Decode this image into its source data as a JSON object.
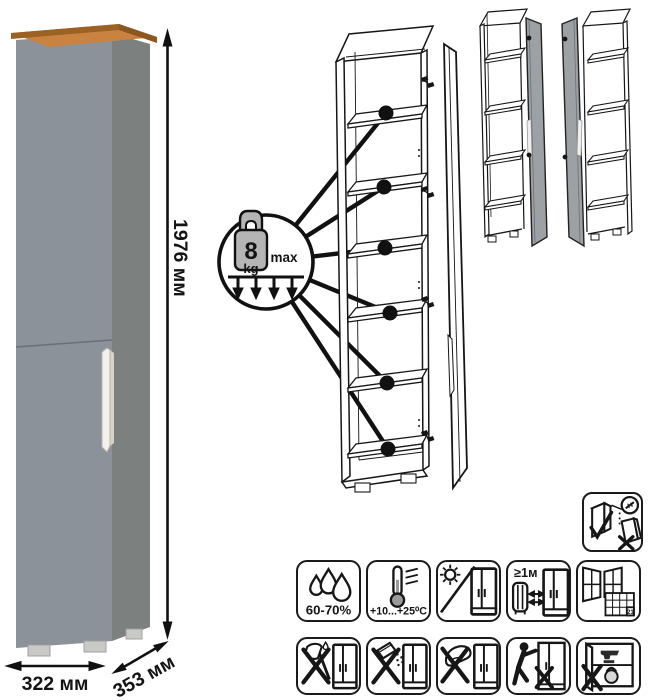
{
  "product": {
    "dimensions": {
      "height": "1976 мм",
      "width": "322 мм",
      "depth": "353 мм"
    },
    "colors": {
      "front": "#8b9299",
      "side": "#7c807e",
      "top_trim": "#c9823f",
      "top_trim_edge": "#9c6124",
      "top_trim_side": "#8d5520",
      "handle": "#f2f1ee",
      "feet": "#c9c9c7",
      "door_shade": "#9ba1a5",
      "outline": "#161616"
    }
  },
  "load_callout": {
    "value": "8",
    "unit": "kg",
    "max_label": "max"
  },
  "icons": {
    "wall_anchor": {
      "name": "wall-anchor-icon"
    },
    "grid": [
      {
        "name": "humidity-icon",
        "label": "60-70%"
      },
      {
        "name": "temperature-icon",
        "label": "+10...+25⁰C"
      },
      {
        "name": "no-direct-sunlight-icon",
        "label": ""
      },
      {
        "name": "heat-distance-icon",
        "label": "≥1м"
      },
      {
        "name": "ventilation-icon",
        "label": "21"
      },
      {
        "name": "no-sharp-tools-icon",
        "label": ""
      },
      {
        "name": "no-abrasive-powder-icon",
        "label": ""
      },
      {
        "name": "no-wet-sponge-icon",
        "label": ""
      },
      {
        "name": "no-dragging-icon",
        "label": ""
      },
      {
        "name": "no-heavy-items-icon",
        "label": ""
      }
    ]
  }
}
